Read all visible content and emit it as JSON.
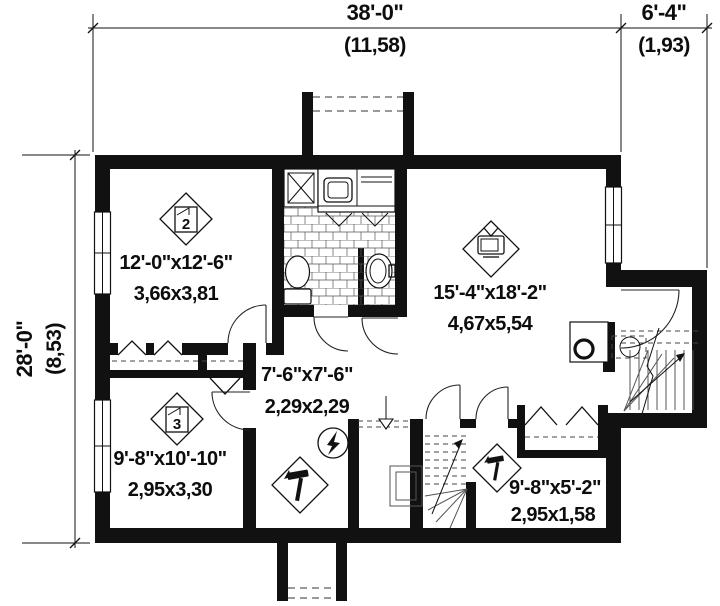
{
  "colors": {
    "ink": "#111111",
    "paper": "#ffffff"
  },
  "dimensions": {
    "width_main_ft": "38'-0\"",
    "width_main_m": "(11,58)",
    "width_ext_ft": "6'-4\"",
    "width_ext_m": "(1,93)",
    "height_ft": "28'-0\"",
    "height_m": "(8,53)"
  },
  "rooms": {
    "bedroom2": {
      "size_ft": "12'-0\"x12'-6\"",
      "size_m": "3,66x3,81",
      "badge": "2",
      "icon": "bed-2-icon"
    },
    "living": {
      "size_ft": "15'-4\"x18'-2\"",
      "size_m": "4,67x5,54",
      "icon": "tv-icon"
    },
    "hall": {
      "size_ft": "7'-6\"x7'-6\"",
      "size_m": "2,29x2,29"
    },
    "bedroom3": {
      "size_ft": "9'-8\"x10'-10\"",
      "size_m": "2,95x3,30",
      "badge": "3",
      "icon": "bed-3-icon"
    },
    "storage": {
      "size_ft": "9'-8\"x5'-2\"",
      "size_m": "2,95x1,58",
      "icon": "hammer-icon"
    }
  },
  "icons": {
    "workshop_area": "hammer-icon",
    "storage_room": "hammer-icon",
    "electrical_panel": "lightning-bolt-icon",
    "media_room": "tv-icon",
    "bedroom2": "bed-2-icon",
    "bedroom3": "bed-3-icon",
    "bath_fixtures": [
      "shower-icon",
      "toilet-icon",
      "pedestal-sink-icon",
      "vanity-sink-icon"
    ],
    "utility": [
      "laundry-tub-icon",
      "water-heater-icon",
      "floor-drain-icon"
    ]
  }
}
